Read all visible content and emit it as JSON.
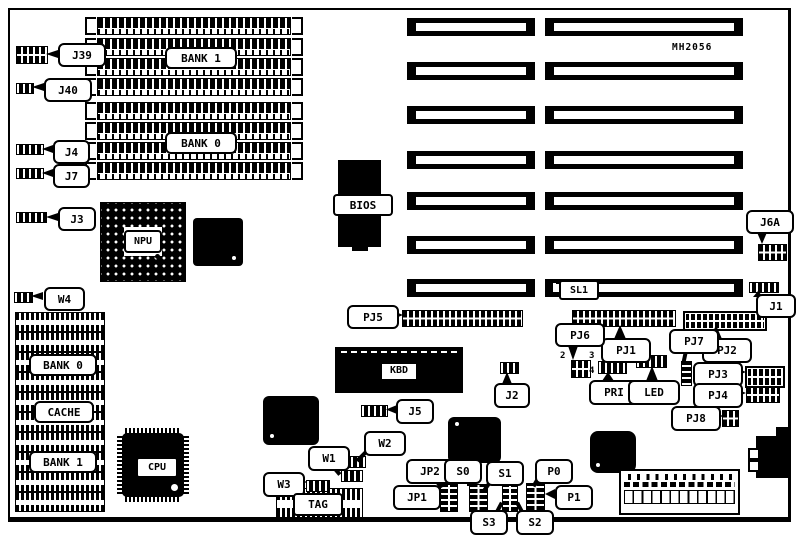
{
  "diagram": {
    "title": "MH2056",
    "memory_banks": {
      "bank1": "BANK 1",
      "bank0": "BANK 0"
    },
    "cache_area": {
      "bank0": "BANK 0",
      "cache": "CACHE",
      "bank1": "BANK 1",
      "tag": "TAG"
    },
    "chips": {
      "npu": "NPU",
      "cpu": "CPU",
      "bios": "BIOS",
      "kbd": "KBD"
    },
    "slot_labels": {
      "sl1": "SL1"
    },
    "connectors": {
      "pj1": "PJ1",
      "pj2": "PJ2",
      "pj3": "PJ3",
      "pj4": "PJ4",
      "pj5": "PJ5",
      "pj6": "PJ6",
      "pj7": "PJ7",
      "pj8": "PJ8",
      "pri": "PRI",
      "led": "LED"
    },
    "jumpers": {
      "j1": "J1",
      "j2": "J2",
      "j3": "J3",
      "j4": "J4",
      "j5": "J5",
      "j6a": "J6A",
      "j7": "J7",
      "j39": "J39",
      "j40": "J40",
      "w1": "W1",
      "w2": "W2",
      "w3": "W3",
      "w4": "W4",
      "jp1": "JP1",
      "jp2": "JP2",
      "s0": "S0",
      "s1": "S1",
      "s2": "S2",
      "s3": "S3",
      "p0": "P0",
      "p1": "P1"
    },
    "pin_numbers": {
      "pj6_pin2": "2",
      "pj6_pin3": "3",
      "pj6_pin4": "4"
    },
    "colors": {
      "ink": "#000000",
      "paper": "#ffffff"
    }
  }
}
